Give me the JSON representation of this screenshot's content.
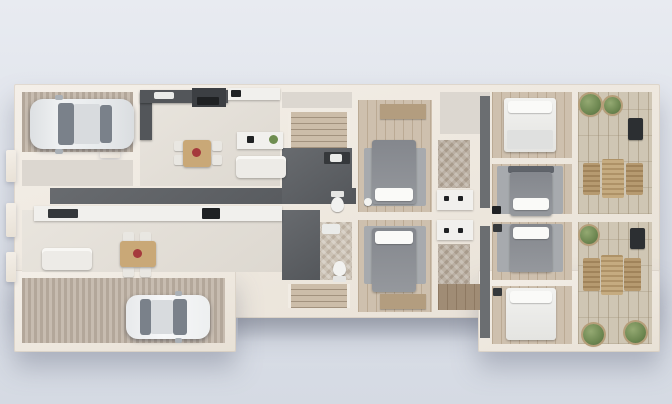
{
  "meta": {
    "view": "3d-top-down-duplex-floor-plan",
    "canvas": {
      "width": 672,
      "height": 404
    }
  },
  "palette": {
    "background_top": "#e8ebf1",
    "background_bottom": "#d5dae3",
    "wall": "#f0ebe3",
    "floor_light": "#e5e1da",
    "floor_dark": "#5d6064",
    "garage_stripe": "#bcb0a4",
    "bedroom_wood": "#cec0ae",
    "deck_wood": "#cfc6b4",
    "bed_gray": "#8c8f95",
    "bed_white": "#efefec",
    "plant_green": "#6c8650",
    "lounge_wood": "#ab8e63",
    "car_silver": "#e9ebed",
    "car_white": "#f4f5f6"
  },
  "structure": {
    "wall_blocks": [
      {
        "name": "building-shell-main",
        "rect": [
          14,
          84,
          646,
          234
        ],
        "small": false
      },
      {
        "name": "building-shell-left-wing",
        "rect": [
          14,
          270,
          222,
          82
        ],
        "small": false
      },
      {
        "name": "building-shell-right-wing",
        "rect": [
          478,
          270,
          182,
          82
        ],
        "small": false
      },
      {
        "name": "entry-pilaster-upper",
        "rect": [
          6,
          150,
          10,
          32
        ],
        "small": true
      },
      {
        "name": "entry-pilaster-middle",
        "rect": [
          6,
          203,
          10,
          34
        ],
        "small": true
      },
      {
        "name": "entry-pilaster-lower",
        "rect": [
          6,
          252,
          10,
          30
        ],
        "small": true
      },
      {
        "name": "garage-a-door-threshold",
        "rect": [
          100,
          150,
          20,
          8
        ],
        "small": true
      }
    ],
    "patio_shadow": {
      "name": "rear-patio-shadow",
      "rect": [
        238,
        318,
        242,
        24
      ]
    }
  },
  "floors": [
    {
      "name": "garage-a-floor",
      "type": "stripes",
      "rect": [
        22,
        92,
        111,
        60
      ]
    },
    {
      "name": "entry-hall-a-floor",
      "type": "light2",
      "rect": [
        22,
        160,
        111,
        26
      ]
    },
    {
      "name": "living-kitchen-a-floor",
      "type": "light",
      "rect": [
        140,
        92,
        140,
        94
      ]
    },
    {
      "name": "corridor-b-floor",
      "type": "dark",
      "rect": [
        50,
        188,
        306,
        16
      ]
    },
    {
      "name": "living-kitchen-b-floor",
      "type": "light",
      "rect": [
        22,
        210,
        260,
        62
      ]
    },
    {
      "name": "garage-b-floor",
      "type": "stripes",
      "rect": [
        22,
        278,
        203,
        65
      ]
    },
    {
      "name": "stair-hall-a-floor",
      "type": "light2",
      "rect": [
        282,
        92,
        70,
        16
      ]
    },
    {
      "name": "stairs-a-floor",
      "type": "stairs",
      "rect": [
        288,
        112,
        62,
        36
      ]
    },
    {
      "name": "bath-hall-a-floor",
      "type": "dark",
      "rect": [
        282,
        148,
        70,
        56
      ]
    },
    {
      "name": "bath-hall-b-floor",
      "type": "dark",
      "rect": [
        282,
        210,
        38,
        70
      ]
    },
    {
      "name": "bathroom-b-floor",
      "type": "herringbone-light",
      "rect": [
        320,
        222,
        32,
        58
      ]
    },
    {
      "name": "stairs-b-floor",
      "type": "stairs",
      "rect": [
        288,
        284,
        62,
        24
      ]
    },
    {
      "name": "master-bedroom-a-floor",
      "type": "wood",
      "rect": [
        358,
        100,
        74,
        112
      ]
    },
    {
      "name": "master-bedroom-b-floor",
      "type": "wood",
      "rect": [
        358,
        220,
        74,
        92
      ]
    },
    {
      "name": "closet-hall-a-floor",
      "type": "light2",
      "rect": [
        440,
        92,
        50,
        42
      ]
    },
    {
      "name": "closet-a-floor",
      "type": "herringbone",
      "rect": [
        438,
        140,
        32,
        48
      ]
    },
    {
      "name": "closet-b-floor",
      "type": "herringbone",
      "rect": [
        438,
        244,
        32,
        56
      ]
    },
    {
      "name": "hall-b-floor",
      "type": "wood-dark",
      "rect": [
        438,
        284,
        46,
        26
      ]
    },
    {
      "name": "bedroom-1-floor",
      "type": "wood",
      "rect": [
        492,
        92,
        80,
        66
      ]
    },
    {
      "name": "bedroom-2-floor",
      "type": "wood",
      "rect": [
        492,
        164,
        80,
        50
      ]
    },
    {
      "name": "bedroom-3-floor",
      "type": "wood",
      "rect": [
        492,
        222,
        80,
        58
      ]
    },
    {
      "name": "bedroom-4-floor",
      "type": "wood",
      "rect": [
        492,
        286,
        80,
        58
      ]
    },
    {
      "name": "balcony-a-floor",
      "type": "deck",
      "rect": [
        578,
        92,
        74,
        122
      ]
    },
    {
      "name": "balcony-b-floor",
      "type": "deck",
      "rect": [
        578,
        222,
        74,
        122
      ]
    }
  ],
  "furniture": [
    {
      "name": "car-a-body",
      "type": "car-body-silver",
      "rect": [
        30,
        99,
        104,
        50
      ]
    },
    {
      "name": "car-a-windshield",
      "type": "car-glass",
      "rect": [
        58,
        103,
        16,
        42
      ]
    },
    {
      "name": "car-a-roof",
      "type": "car-roof",
      "rect": [
        74,
        104,
        26,
        40
      ]
    },
    {
      "name": "car-a-rear-window",
      "type": "car-glass",
      "rect": [
        100,
        105,
        12,
        38
      ]
    },
    {
      "name": "car-a-mirror-top",
      "type": "car-mirror",
      "rect": [
        55,
        95,
        8,
        5
      ]
    },
    {
      "name": "car-a-mirror-bottom",
      "type": "car-mirror",
      "rect": [
        55,
        149,
        8,
        5
      ]
    },
    {
      "name": "car-b-body",
      "type": "car-body-white",
      "rect": [
        126,
        295,
        84,
        44
      ]
    },
    {
      "name": "car-b-rear-window",
      "type": "car-glass",
      "rect": [
        140,
        299,
        11,
        36
      ]
    },
    {
      "name": "car-b-roof",
      "type": "car-roof",
      "rect": [
        151,
        300,
        22,
        34
      ]
    },
    {
      "name": "car-b-windshield",
      "type": "car-glass",
      "rect": [
        173,
        299,
        14,
        36
      ]
    },
    {
      "name": "car-b-mirror-top",
      "type": "car-mirror",
      "rect": [
        175,
        291,
        7,
        5
      ]
    },
    {
      "name": "car-b-mirror-bottom",
      "type": "car-mirror",
      "rect": [
        175,
        338,
        7,
        5
      ]
    },
    {
      "name": "kitchen-a-counter-left",
      "type": "counter-dark",
      "rect": [
        140,
        92,
        12,
        48
      ]
    },
    {
      "name": "kitchen-a-counter-top",
      "type": "counter-dark",
      "rect": [
        140,
        90,
        88,
        13
      ]
    },
    {
      "name": "kitchen-a-sink",
      "type": "sink-white",
      "rect": [
        154,
        92,
        20,
        7
      ]
    },
    {
      "name": "kitchen-a-stove",
      "type": "stove-dark",
      "rect": [
        192,
        88,
        34,
        19
      ]
    },
    {
      "name": "kitchen-a-cooktop",
      "type": "appliance-black",
      "rect": [
        197,
        97,
        22,
        8
      ]
    },
    {
      "name": "kitchen-a-counter-right",
      "type": "counter-white",
      "rect": [
        228,
        88,
        52,
        12
      ]
    },
    {
      "name": "kitchen-a-basin",
      "type": "appliance-black",
      "rect": [
        231,
        90,
        10,
        7
      ]
    },
    {
      "name": "kitchen-a-island",
      "type": "counter-white",
      "rect": [
        237,
        132,
        46,
        17
      ]
    },
    {
      "name": "kitchen-a-island-plant",
      "type": "deco-green",
      "rect": [
        269,
        135,
        9,
        9
      ]
    },
    {
      "name": "kitchen-a-island-appliance",
      "type": "appliance-black",
      "rect": [
        247,
        136,
        7,
        7
      ]
    },
    {
      "name": "sofa-a",
      "type": "sofa-white",
      "rect": [
        236,
        156,
        50,
        22
      ]
    },
    {
      "name": "dining-a-chair-1",
      "type": "chair-white",
      "rect": [
        174,
        141,
        10,
        10
      ]
    },
    {
      "name": "dining-a-chair-2",
      "type": "chair-white",
      "rect": [
        174,
        155,
        10,
        10
      ]
    },
    {
      "name": "dining-a-chair-3",
      "type": "chair-white",
      "rect": [
        212,
        141,
        10,
        10
      ]
    },
    {
      "name": "dining-a-chair-4",
      "type": "chair-white",
      "rect": [
        212,
        155,
        10,
        10
      ]
    },
    {
      "name": "dining-a-table",
      "type": "table-wood",
      "rect": [
        183,
        140,
        28,
        27
      ]
    },
    {
      "name": "dining-a-centerpiece",
      "type": "deco-red",
      "rect": [
        192,
        148,
        9,
        9
      ]
    },
    {
      "name": "kitchen-b-counter",
      "type": "counter-white",
      "rect": [
        34,
        206,
        248,
        15
      ]
    },
    {
      "name": "kitchen-b-sink",
      "type": "appliance-dark",
      "rect": [
        48,
        209,
        30,
        9
      ]
    },
    {
      "name": "kitchen-b-cooktop",
      "type": "appliance-black",
      "rect": [
        202,
        208,
        18,
        11
      ]
    },
    {
      "name": "sofa-b",
      "type": "sofa-white",
      "rect": [
        42,
        248,
        50,
        22
      ]
    },
    {
      "name": "dining-b-chair-1",
      "type": "chair-white",
      "rect": [
        123,
        232,
        11,
        10
      ]
    },
    {
      "name": "dining-b-chair-2",
      "type": "chair-white",
      "rect": [
        140,
        232,
        11,
        10
      ]
    },
    {
      "name": "dining-b-chair-3",
      "type": "chair-white",
      "rect": [
        123,
        267,
        11,
        10
      ]
    },
    {
      "name": "dining-b-chair-4",
      "type": "chair-white",
      "rect": [
        140,
        267,
        11,
        10
      ]
    },
    {
      "name": "dining-b-table",
      "type": "table-wood",
      "rect": [
        120,
        241,
        36,
        26
      ]
    },
    {
      "name": "dining-b-centerpiece",
      "type": "deco-red",
      "rect": [
        133,
        249,
        9,
        9
      ]
    },
    {
      "name": "bath-a-vanity",
      "type": "appliance-dark",
      "rect": [
        324,
        152,
        26,
        12
      ]
    },
    {
      "name": "bath-a-basin",
      "type": "sink-white",
      "rect": [
        330,
        154,
        12,
        8
      ]
    },
    {
      "name": "toilet-a-tank",
      "type": "toilet-tank",
      "rect": [
        331,
        191,
        13,
        6
      ]
    },
    {
      "name": "toilet-a-bowl",
      "type": "toilet-bowl",
      "rect": [
        331,
        197,
        13,
        15
      ]
    },
    {
      "name": "bath-b-sink",
      "type": "sink-white",
      "rect": [
        322,
        224,
        18,
        10
      ]
    },
    {
      "name": "toilet-b-bowl",
      "type": "toilet-bowl",
      "rect": [
        333,
        261,
        13,
        15
      ]
    },
    {
      "name": "toilet-b-tank",
      "type": "toilet-tank",
      "rect": [
        333,
        276,
        13,
        6
      ]
    },
    {
      "name": "master-a-wardrobe",
      "type": "wardrobe-wood",
      "rect": [
        380,
        104,
        46,
        15
      ]
    },
    {
      "name": "master-a-rug",
      "type": "rug",
      "rect": [
        364,
        148,
        62,
        58
      ]
    },
    {
      "name": "master-a-bed",
      "type": "bed-gray",
      "rect": [
        372,
        140,
        44,
        64
      ]
    },
    {
      "name": "master-a-pillows",
      "type": "pillow-white",
      "rect": [
        375,
        188,
        38,
        13
      ]
    },
    {
      "name": "master-a-lamp",
      "type": "deco-white-round",
      "rect": [
        364,
        198,
        8,
        8
      ]
    },
    {
      "name": "master-b-rug",
      "type": "rug",
      "rect": [
        364,
        226,
        62,
        58
      ]
    },
    {
      "name": "master-b-bed",
      "type": "bed-gray",
      "rect": [
        372,
        228,
        44,
        64
      ]
    },
    {
      "name": "master-b-pillows",
      "type": "pillow-white",
      "rect": [
        375,
        231,
        38,
        13
      ]
    },
    {
      "name": "master-b-wardrobe",
      "type": "wardrobe-wood",
      "rect": [
        380,
        294,
        46,
        15
      ]
    },
    {
      "name": "vanity-a-counter",
      "type": "counter-white",
      "rect": [
        437,
        190,
        36,
        20
      ]
    },
    {
      "name": "vanity-a-faucet-1",
      "type": "appliance-black",
      "rect": [
        444,
        196,
        5,
        5
      ]
    },
    {
      "name": "vanity-a-faucet-2",
      "type": "appliance-black",
      "rect": [
        458,
        196,
        5,
        5
      ]
    },
    {
      "name": "vanity-b-counter",
      "type": "counter-white",
      "rect": [
        437,
        220,
        36,
        20
      ]
    },
    {
      "name": "vanity-b-faucet-1",
      "type": "appliance-black",
      "rect": [
        444,
        228,
        5,
        5
      ]
    },
    {
      "name": "vanity-b-faucet-2",
      "type": "appliance-black",
      "rect": [
        458,
        228,
        5,
        5
      ]
    },
    {
      "name": "wardrobe-strip-a",
      "type": "wardrobe-dark",
      "rect": [
        480,
        96,
        10,
        112
      ]
    },
    {
      "name": "wardrobe-strip-b",
      "type": "wardrobe-dark",
      "rect": [
        480,
        226,
        10,
        112
      ]
    },
    {
      "name": "bedroom-1-bed",
      "type": "bed-white",
      "rect": [
        504,
        98,
        52,
        54
      ]
    },
    {
      "name": "bedroom-1-pillows",
      "type": "pillow-white",
      "rect": [
        508,
        101,
        44,
        12
      ]
    },
    {
      "name": "bedroom-1-blanket",
      "type": "bed-fold",
      "rect": [
        507,
        130,
        46,
        19
      ]
    },
    {
      "name": "bedroom-2-rug",
      "type": "rug",
      "rect": [
        497,
        166,
        66,
        48
      ]
    },
    {
      "name": "bedroom-2-headboard",
      "type": "headboard-dark",
      "rect": [
        508,
        166,
        46,
        7
      ]
    },
    {
      "name": "bedroom-2-bed",
      "type": "bed-gray",
      "rect": [
        510,
        172,
        42,
        44
      ]
    },
    {
      "name": "bedroom-2-bench",
      "type": "pillow-white",
      "rect": [
        513,
        198,
        36,
        12
      ]
    },
    {
      "name": "bedroom-2-stool",
      "type": "appliance-black",
      "rect": [
        492,
        206,
        9,
        8
      ]
    },
    {
      "name": "bedroom-3-rug",
      "type": "rug",
      "rect": [
        497,
        224,
        66,
        48
      ]
    },
    {
      "name": "bedroom-3-bed",
      "type": "bed-gray",
      "rect": [
        510,
        224,
        42,
        48
      ]
    },
    {
      "name": "bedroom-3-pillows",
      "type": "pillow-white",
      "rect": [
        513,
        227,
        36,
        12
      ]
    },
    {
      "name": "bedroom-3-nightstand",
      "type": "appliance-dark",
      "rect": [
        493,
        224,
        9,
        8
      ]
    },
    {
      "name": "bedroom-4-bed",
      "type": "bed-white",
      "rect": [
        506,
        288,
        50,
        52
      ]
    },
    {
      "name": "bedroom-4-pillows",
      "type": "pillow-white",
      "rect": [
        510,
        291,
        42,
        12
      ]
    },
    {
      "name": "bedroom-4-nightstand",
      "type": "appliance-dark",
      "rect": [
        493,
        288,
        9,
        8
      ]
    },
    {
      "name": "balcony-a-plant-1",
      "type": "plant",
      "rect": [
        580,
        94,
        21,
        21
      ]
    },
    {
      "name": "balcony-a-plant-2",
      "type": "plant",
      "rect": [
        604,
        97,
        17,
        17
      ]
    },
    {
      "name": "balcony-a-patio-chair",
      "type": "chair-dark",
      "rect": [
        628,
        118,
        15,
        22
      ]
    },
    {
      "name": "balcony-a-lounge-left",
      "type": "lounge-chair",
      "rect": [
        583,
        163,
        17,
        32
      ]
    },
    {
      "name": "balcony-a-lounge-table",
      "type": "lounge-table",
      "rect": [
        602,
        159,
        22,
        39
      ]
    },
    {
      "name": "balcony-a-lounge-right",
      "type": "lounge-chair",
      "rect": [
        626,
        163,
        17,
        32
      ]
    },
    {
      "name": "balcony-b-plant-1",
      "type": "plant",
      "rect": [
        580,
        226,
        18,
        18
      ]
    },
    {
      "name": "balcony-b-patio-chair",
      "type": "chair-dark",
      "rect": [
        630,
        228,
        15,
        21
      ]
    },
    {
      "name": "balcony-b-lounge-left",
      "type": "lounge-chair",
      "rect": [
        583,
        258,
        17,
        33
      ]
    },
    {
      "name": "balcony-b-lounge-table",
      "type": "lounge-table",
      "rect": [
        601,
        255,
        22,
        40
      ]
    },
    {
      "name": "balcony-b-lounge-right",
      "type": "lounge-chair",
      "rect": [
        624,
        258,
        17,
        33
      ]
    },
    {
      "name": "balcony-b-plant-2",
      "type": "plant",
      "rect": [
        583,
        324,
        21,
        21
      ]
    },
    {
      "name": "balcony-b-plant-3",
      "type": "plant",
      "rect": [
        625,
        322,
        21,
        21
      ]
    }
  ]
}
